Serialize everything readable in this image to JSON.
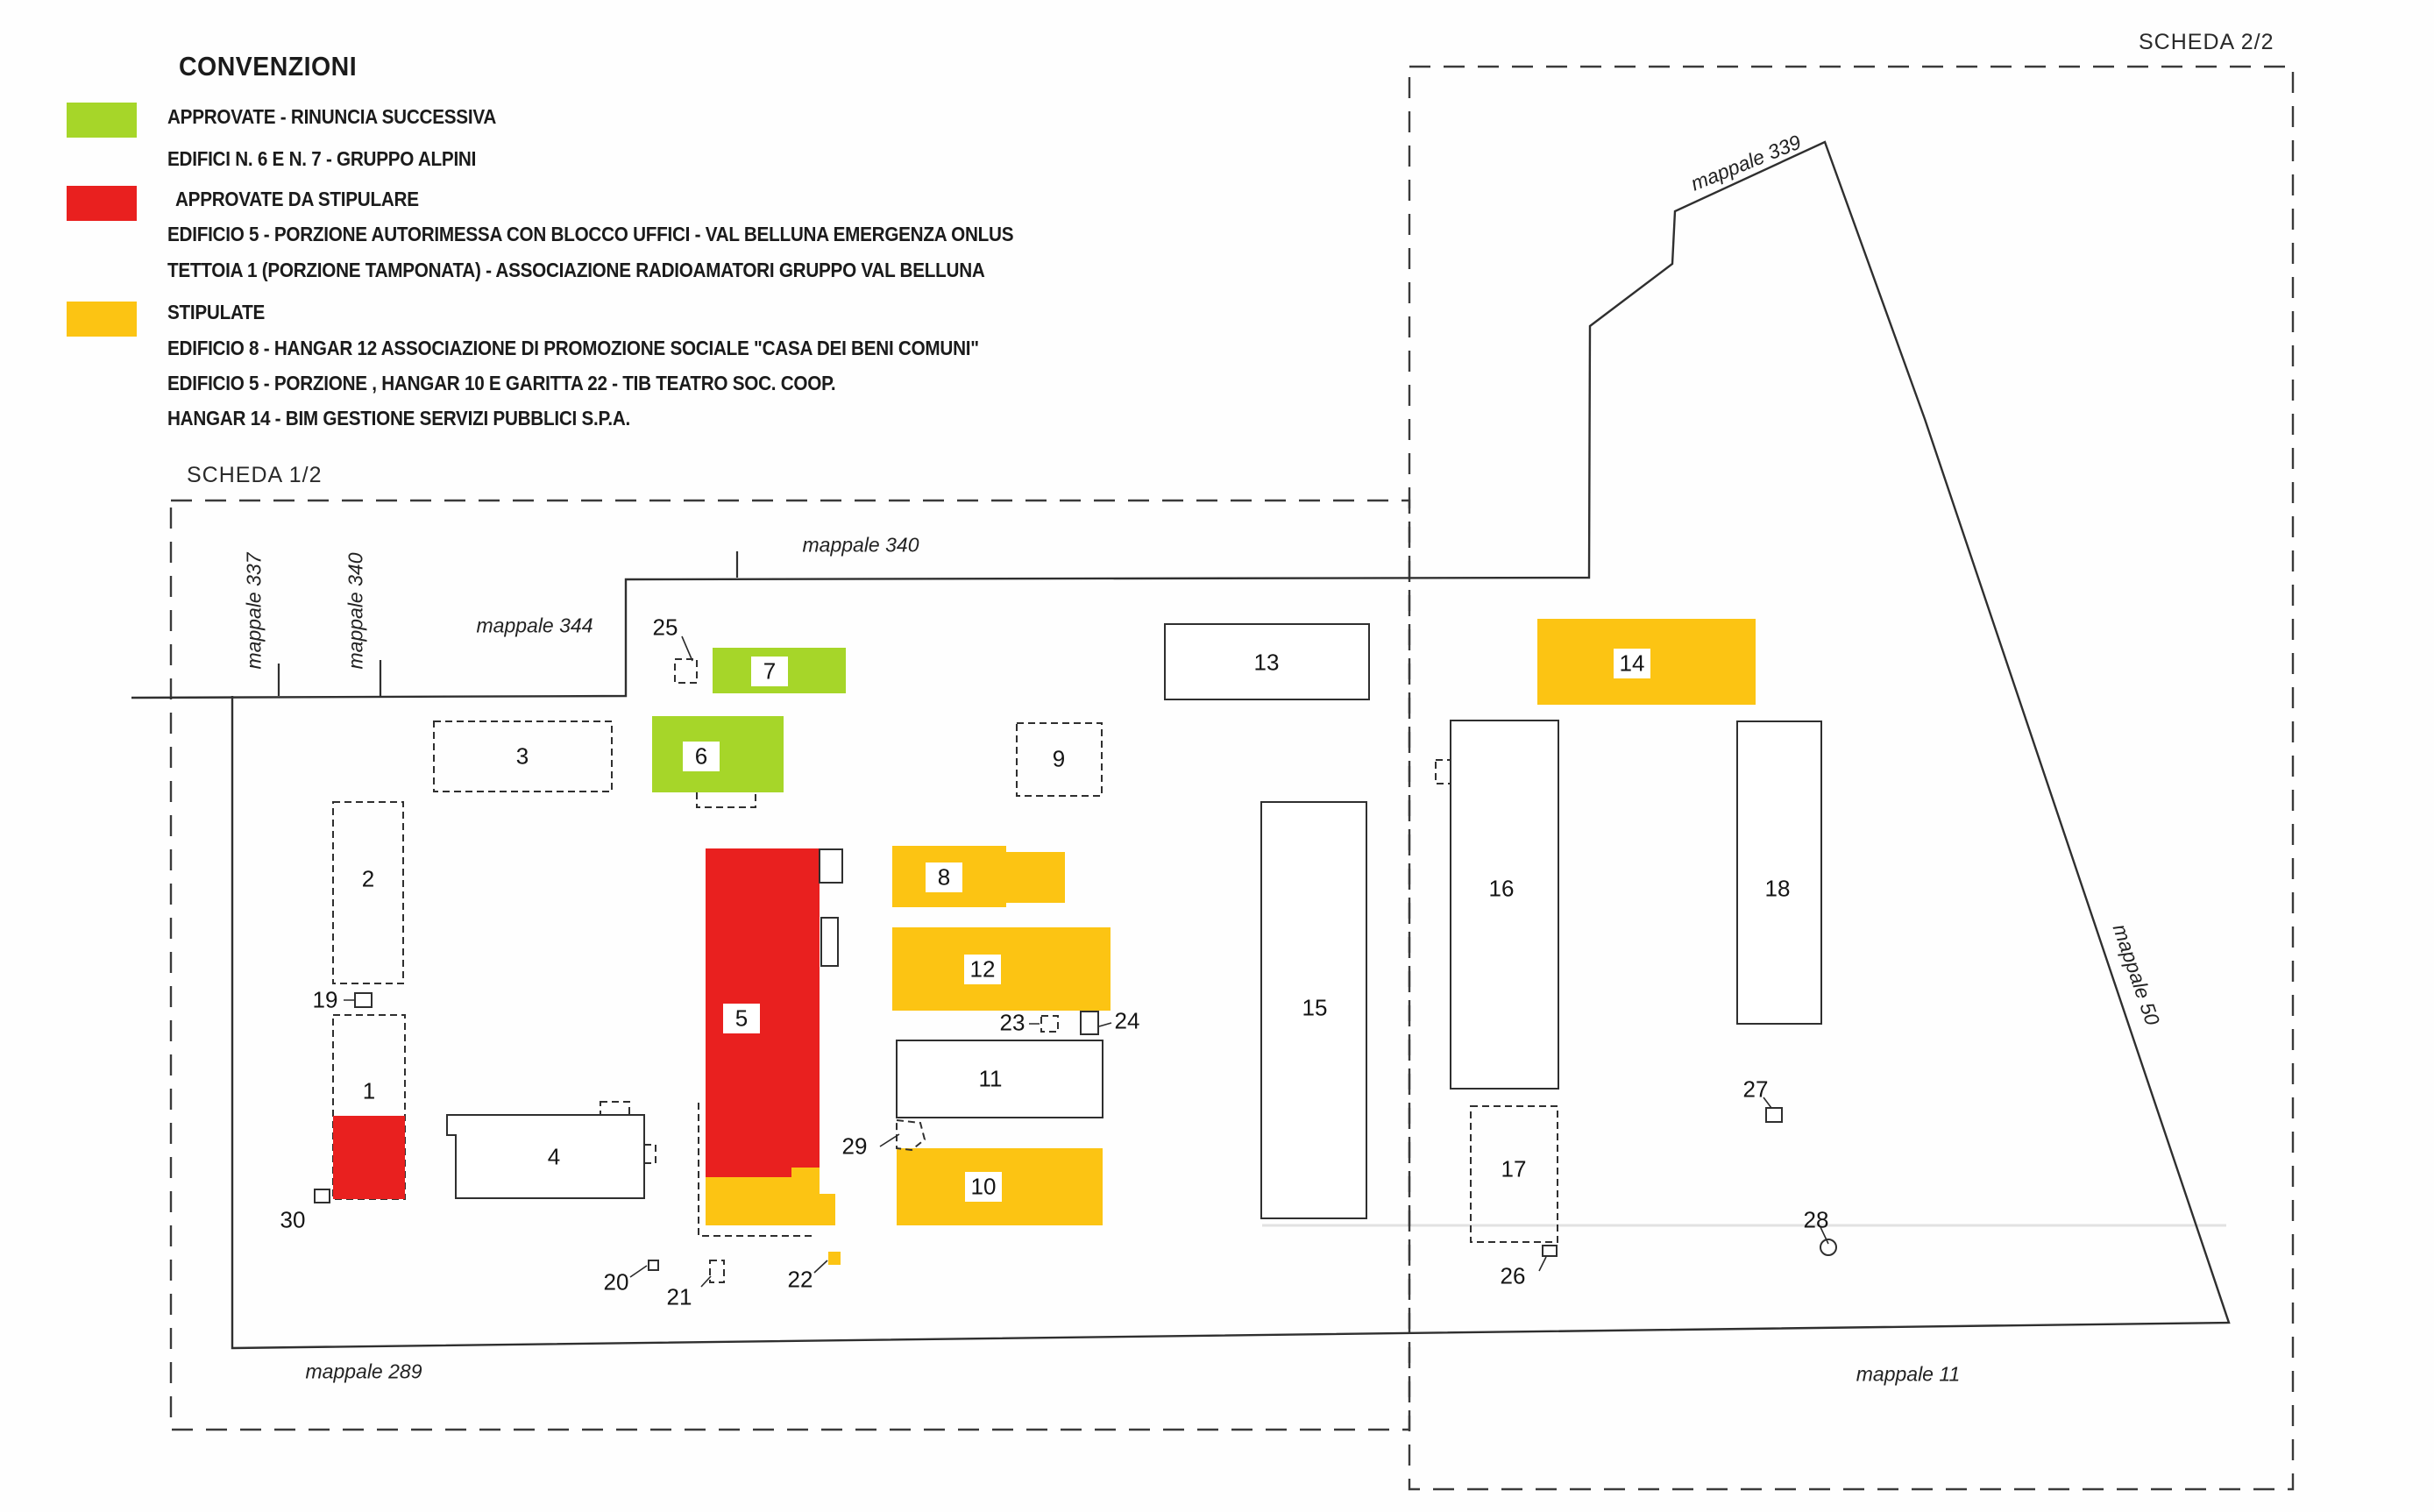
{
  "page": {
    "title_scheda_2": "SCHEDA 2/2",
    "title_scheda_1": "SCHEDA 1/2"
  },
  "colors": {
    "green": "#a6d629",
    "red": "#e9201f",
    "yellow": "#fcc413",
    "line": "#2f2f2f"
  },
  "legend": {
    "title": "CONVENZIONI",
    "groups": [
      {
        "swatch": "green",
        "heading": "APPROVATE - RINUNCIA SUCCESSIVA",
        "lines": [
          "EDIFICI N. 6 E N. 7 - GRUPPO ALPINI"
        ]
      },
      {
        "swatch": "red",
        "heading": "APPROVATE DA STIPULARE",
        "lines": [
          "EDIFICIO 5 - PORZIONE AUTORIMESSA CON BLOCCO UFFICI - VAL BELLUNA EMERGENZA ONLUS",
          "TETTOIA 1 (PORZIONE TAMPONATA) - ASSOCIAZIONE RADIOAMATORI GRUPPO VAL BELLUNA"
        ]
      },
      {
        "swatch": "yellow",
        "heading": "STIPULATE",
        "lines": [
          "EDIFICIO 8 -  HANGAR 12   ASSOCIAZIONE DI PROMOZIONE SOCIALE \"CASA DEI BENI COMUNI\"",
          "EDIFICIO 5 - PORZIONE , HANGAR 10 E GARITTA 22  - TIB TEATRO SOC. COOP.",
          "HANGAR 14 - BIM GESTIONE SERVIZI PUBBLICI S.P.A."
        ]
      }
    ]
  },
  "map_labels": [
    {
      "id": "mappale-337",
      "text": "mappale 337"
    },
    {
      "id": "mappale-340-left",
      "text": "mappale 340"
    },
    {
      "id": "mappale-344",
      "text": "mappale 344"
    },
    {
      "id": "mappale-340-top",
      "text": "mappale 340"
    },
    {
      "id": "mappale-339",
      "text": "mappale 339"
    },
    {
      "id": "mappale-50",
      "text": "mappale 50"
    },
    {
      "id": "mappale-289",
      "text": "mappale 289"
    },
    {
      "id": "mappale-11",
      "text": "mappale 11"
    }
  ],
  "buildings": [
    {
      "label": "1",
      "status": "red_partial"
    },
    {
      "label": "2",
      "status": "outline_dashed"
    },
    {
      "label": "3",
      "status": "outline_dashed"
    },
    {
      "label": "4",
      "status": "outline_solid"
    },
    {
      "label": "5",
      "status": "red_yellow"
    },
    {
      "label": "6",
      "status": "green"
    },
    {
      "label": "7",
      "status": "green"
    },
    {
      "label": "8",
      "status": "yellow"
    },
    {
      "label": "9",
      "status": "outline_dashed"
    },
    {
      "label": "10",
      "status": "yellow"
    },
    {
      "label": "11",
      "status": "outline_solid"
    },
    {
      "label": "12",
      "status": "yellow"
    },
    {
      "label": "13",
      "status": "outline_solid"
    },
    {
      "label": "14",
      "status": "yellow"
    },
    {
      "label": "15",
      "status": "outline_solid"
    },
    {
      "label": "16",
      "status": "outline_solid"
    },
    {
      "label": "17",
      "status": "outline_dashed"
    },
    {
      "label": "18",
      "status": "outline_solid"
    },
    {
      "label": "19",
      "status": "marker_solid"
    },
    {
      "label": "20",
      "status": "marker_solid"
    },
    {
      "label": "21",
      "status": "marker_dashed"
    },
    {
      "label": "22",
      "status": "marker_yellow"
    },
    {
      "label": "23",
      "status": "marker_dashed"
    },
    {
      "label": "24",
      "status": "marker_solid"
    },
    {
      "label": "25",
      "status": "marker_dashed"
    },
    {
      "label": "26",
      "status": "marker_solid"
    },
    {
      "label": "27",
      "status": "marker_solid"
    },
    {
      "label": "28",
      "status": "marker_circle"
    },
    {
      "label": "29",
      "status": "marker_dashed"
    },
    {
      "label": "30",
      "status": "marker_solid"
    }
  ]
}
